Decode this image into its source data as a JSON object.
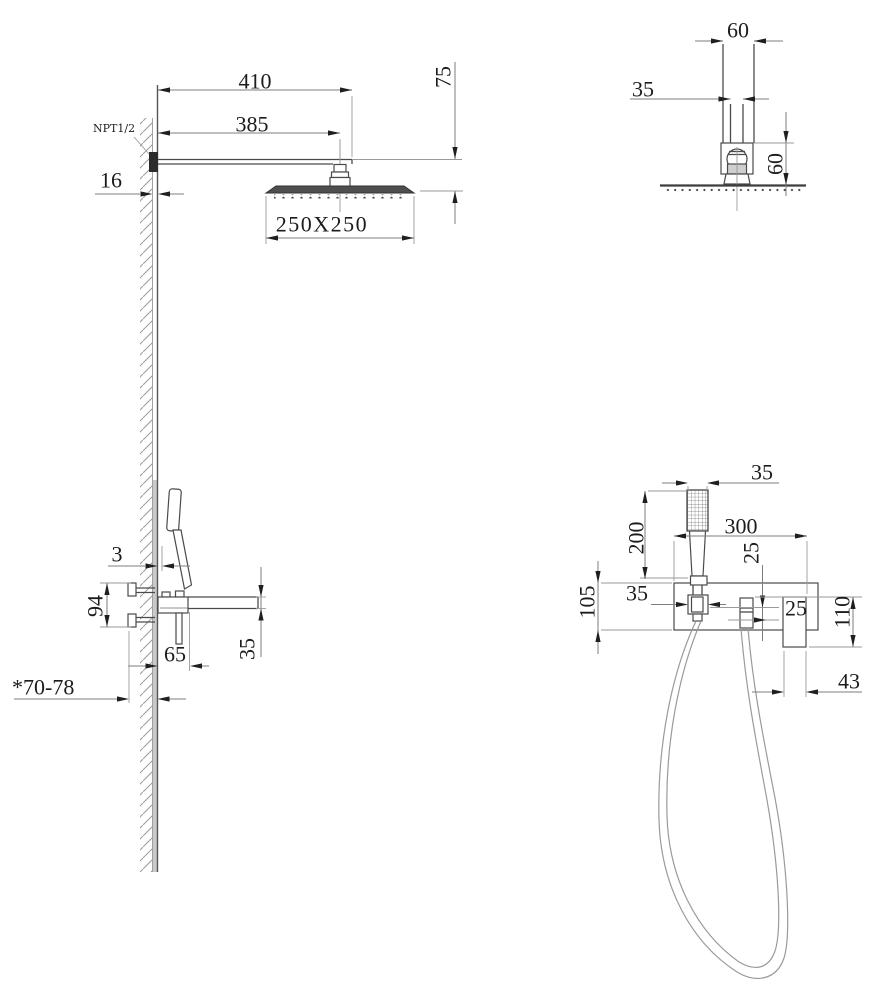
{
  "colors": {
    "background": "#ffffff",
    "object_line": "#4a4a4a",
    "dimension_line": "#7d7d7d",
    "text": "#1c1c1c",
    "wall_fill": "#c9c9c9",
    "connector_fill": "#2b2b2b"
  },
  "views": {
    "rain_shower_side": {
      "inlet_thread": "NPT1/2",
      "arm_length": "410",
      "arm_to_head_center": "385",
      "head_drop": "75",
      "wall_thickness": "16",
      "head_size": "250X250"
    },
    "rain_shower_front": {
      "arm_width": "60",
      "connector_width": "35",
      "head_clearance": "60"
    },
    "mixer_side": {
      "handle_wall_gap": "3",
      "inlet_span": "94",
      "body_projection": "65",
      "spout_height": "35",
      "embed_depth": "*70-78"
    },
    "mixer_front": {
      "handset_width": "35",
      "handset_height": "200",
      "plate_width": "300",
      "outlet_gap": "25",
      "holder_width": "35",
      "plate_height": "105",
      "outlet_inset": "25",
      "elbow_height": "110",
      "elbow_width": "43"
    }
  }
}
